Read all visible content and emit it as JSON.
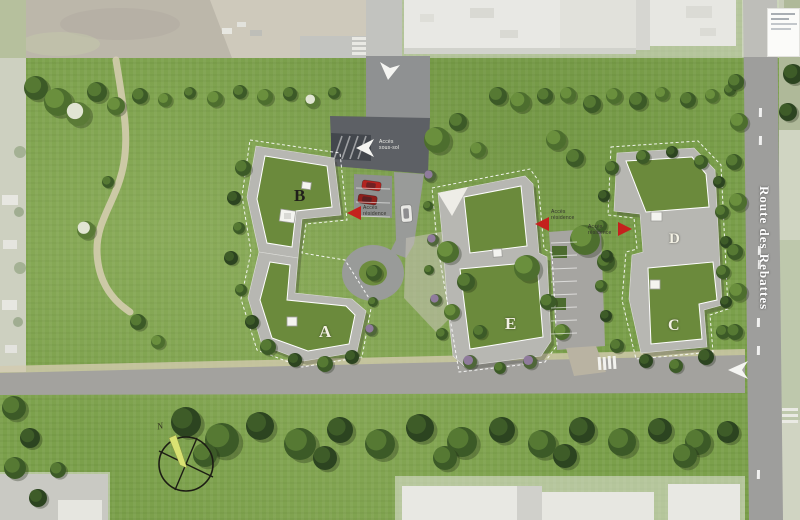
{
  "labels": {
    "building_a": "A",
    "building_b": "B",
    "building_c": "C",
    "building_d": "D",
    "building_e": "E"
  },
  "road": {
    "name": "Route des Rebattes"
  },
  "annotations": {
    "basement_access": {
      "line1": "Accès",
      "line2": "sous-sol"
    },
    "residence_access_west": {
      "line1": "Accès",
      "line2": "résidence"
    },
    "residence_access_center": {
      "line1": "Accès",
      "line2": "résidence"
    },
    "residence_access_east": {
      "line1": "Accès",
      "line2": "résidence"
    }
  },
  "compass": {
    "north": "N"
  },
  "colors": {
    "lawn": "#7ba04b",
    "roof_green": "#6b8a3c",
    "building_grey": "#b7b7b2",
    "road_grey": "#9a9a97",
    "access_arrow_red": "#c4211d",
    "compass_needle": "#d9e272",
    "path_beige": "#d8cfb4"
  }
}
